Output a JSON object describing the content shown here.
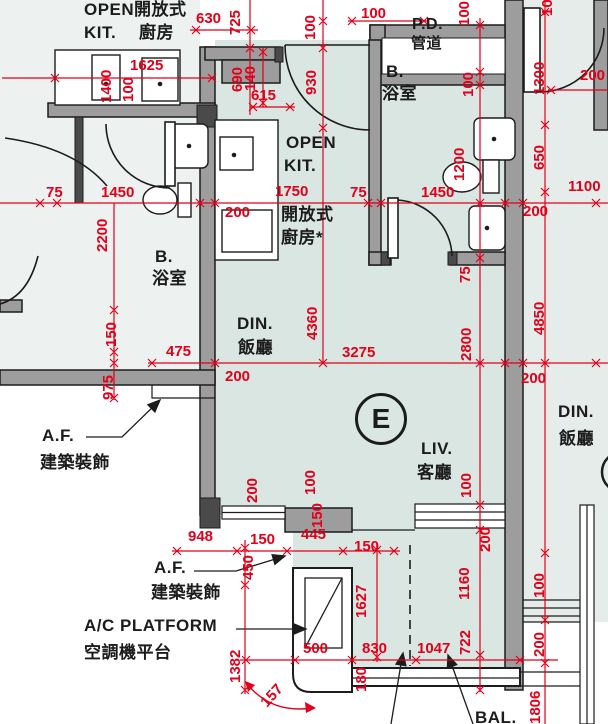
{
  "drawing": {
    "type": "floor-plan",
    "unit": {
      "label": "E"
    }
  },
  "colors": {
    "dimension_red": "#e2001a",
    "wall_fill": "#9d9d9d",
    "wall_dark": "#4a4a4a",
    "line_black": "#1c1c1c",
    "floor_unit_e": "#d9e6e1",
    "floor_left_unit": "#edf1ef",
    "floor_right_unit": "#e6ece9",
    "fixture_white": "#ffffff"
  },
  "annotations": {
    "room_labels": [
      {
        "name": "open-kit-left-line1",
        "text": "OPEN",
        "x": 84,
        "y": 1
      },
      {
        "name": "open-kit-left-line2",
        "text": "KIT.",
        "x": 84,
        "y": 24
      },
      {
        "name": "open-kit-left-zh-line1",
        "text": "開放式",
        "x": 134,
        "y": 1
      },
      {
        "name": "open-kit-left-zh-line2",
        "text": "廚房",
        "x": 139,
        "y": 24
      },
      {
        "name": "pipe-duct-label",
        "text": "P.D.",
        "x": 412,
        "y": 17,
        "size": 16
      },
      {
        "name": "pipe-duct-label-zh",
        "text": "管道",
        "x": 411,
        "y": 36,
        "size": 15
      },
      {
        "name": "bathroom-e-label",
        "text": "B.",
        "x": 386,
        "y": 63
      },
      {
        "name": "bathroom-e-label-zh",
        "text": "浴室",
        "x": 382,
        "y": 85
      },
      {
        "name": "open-kit-e-line1",
        "text": "OPEN",
        "x": 286,
        "y": 134
      },
      {
        "name": "open-kit-e-line2",
        "text": "KIT.",
        "x": 284,
        "y": 157
      },
      {
        "name": "open-kit-e-zh-line1",
        "text": "開放式",
        "x": 281,
        "y": 206
      },
      {
        "name": "open-kit-e-zh-line2",
        "text": "廚房*",
        "x": 281,
        "y": 229
      },
      {
        "name": "bathroom-left-label",
        "text": "B.",
        "x": 155,
        "y": 248
      },
      {
        "name": "bathroom-left-label-zh",
        "text": "浴室",
        "x": 152,
        "y": 270
      },
      {
        "name": "dining-e-label",
        "text": "DIN.",
        "x": 237,
        "y": 315
      },
      {
        "name": "dining-e-label-zh",
        "text": "飯廳",
        "x": 238,
        "y": 339
      },
      {
        "name": "living-e-label",
        "text": "LIV.",
        "x": 421,
        "y": 440
      },
      {
        "name": "living-e-label-zh",
        "text": "客廳",
        "x": 417,
        "y": 464
      },
      {
        "name": "dining-right-label",
        "text": "DIN.",
        "x": 558,
        "y": 403
      },
      {
        "name": "dining-right-label-zh",
        "text": "飯廳",
        "x": 559,
        "y": 430
      },
      {
        "name": "af-upper-label",
        "text": "A.F.",
        "x": 42,
        "y": 427
      },
      {
        "name": "af-upper-label-zh",
        "text": "建築裝飾",
        "x": 40,
        "y": 454
      },
      {
        "name": "af-lower-label",
        "text": "A.F.",
        "x": 154,
        "y": 559
      },
      {
        "name": "af-lower-label-zh",
        "text": "建築裝飾",
        "x": 151,
        "y": 584
      },
      {
        "name": "ac-platform-label",
        "text": "A/C PLATFORM",
        "x": 84,
        "y": 617
      },
      {
        "name": "ac-platform-label-zh",
        "text": "空調機平台",
        "x": 84,
        "y": 644
      },
      {
        "name": "balcony-label",
        "text": "BAL.",
        "x": 475,
        "y": 709
      }
    ],
    "dimension_labels": [
      {
        "text": "630",
        "x": 196,
        "y": 11
      },
      {
        "text": "725",
        "x": 228,
        "y": 35,
        "rot": -90
      },
      {
        "text": "100",
        "x": 303,
        "y": 40,
        "rot": -90
      },
      {
        "text": "930",
        "x": 304,
        "y": 95,
        "rot": -90
      },
      {
        "text": "100",
        "x": 361,
        "y": 6
      },
      {
        "text": "100",
        "x": 457,
        "y": 26,
        "rot": -90
      },
      {
        "text": "100",
        "x": 540,
        "y": 16,
        "rot": -90
      },
      {
        "text": "1400",
        "x": 99,
        "y": 103,
        "rot": -90
      },
      {
        "text": "1625",
        "x": 130,
        "y": 58
      },
      {
        "text": "100",
        "x": 121,
        "y": 102,
        "rot": -90
      },
      {
        "text": "690",
        "x": 230,
        "y": 92,
        "rot": -90
      },
      {
        "text": "140",
        "x": 243,
        "y": 91,
        "rot": -90
      },
      {
        "text": "615",
        "x": 251,
        "y": 88
      },
      {
        "text": "100",
        "x": 461,
        "y": 97,
        "rot": -90
      },
      {
        "text": "1300",
        "x": 532,
        "y": 95,
        "rot": -90
      },
      {
        "text": "200",
        "x": 580,
        "y": 68
      },
      {
        "text": "1200",
        "x": 452,
        "y": 181,
        "rot": -90
      },
      {
        "text": "650",
        "x": 532,
        "y": 170,
        "rot": -90
      },
      {
        "text": "1100",
        "x": 568,
        "y": 179
      },
      {
        "text": "75",
        "x": 46,
        "y": 185
      },
      {
        "text": "1450",
        "x": 101,
        "y": 185
      },
      {
        "text": "1750",
        "x": 275,
        "y": 184
      },
      {
        "text": "75",
        "x": 350,
        "y": 185
      },
      {
        "text": "1450",
        "x": 421,
        "y": 185
      },
      {
        "text": "200",
        "x": 225,
        "y": 205
      },
      {
        "text": "200",
        "x": 523,
        "y": 204
      },
      {
        "text": "2200",
        "x": 95,
        "y": 252,
        "rot": -90
      },
      {
        "text": "75",
        "x": 458,
        "y": 283,
        "rot": -90
      },
      {
        "text": "475",
        "x": 166,
        "y": 344
      },
      {
        "text": "150",
        "x": 104,
        "y": 347,
        "rot": -90
      },
      {
        "text": "975",
        "x": 101,
        "y": 400,
        "rot": -90
      },
      {
        "text": "4360",
        "x": 305,
        "y": 340,
        "rot": -90
      },
      {
        "text": "3275",
        "x": 342,
        "y": 345
      },
      {
        "text": "2800",
        "x": 459,
        "y": 361,
        "rot": -90
      },
      {
        "text": "4850",
        "x": 532,
        "y": 335,
        "rot": -90
      },
      {
        "text": "200",
        "x": 225,
        "y": 369
      },
      {
        "text": "200",
        "x": 521,
        "y": 371
      },
      {
        "text": "100",
        "x": 303,
        "y": 495,
        "rot": -90
      },
      {
        "text": "150",
        "x": 310,
        "y": 528,
        "rot": -90
      },
      {
        "text": "200",
        "x": 245,
        "y": 503,
        "rot": -90
      },
      {
        "text": "100",
        "x": 459,
        "y": 498,
        "rot": -90
      },
      {
        "text": "200",
        "x": 478,
        "y": 552,
        "rot": -90
      },
      {
        "text": "948",
        "x": 188,
        "y": 529
      },
      {
        "text": "450",
        "x": 241,
        "y": 580,
        "rot": -90
      },
      {
        "text": "150",
        "x": 250,
        "y": 532
      },
      {
        "text": "445",
        "x": 301,
        "y": 527
      },
      {
        "text": "150",
        "x": 354,
        "y": 539
      },
      {
        "text": "1627",
        "x": 354,
        "y": 618,
        "rot": -90
      },
      {
        "text": "1160",
        "x": 457,
        "y": 600,
        "rot": -90
      },
      {
        "text": "722",
        "x": 458,
        "y": 655,
        "rot": -90
      },
      {
        "text": "100",
        "x": 532,
        "y": 598,
        "rot": -90
      },
      {
        "text": "200",
        "x": 532,
        "y": 657,
        "rot": -90
      },
      {
        "text": "1806",
        "x": 528,
        "y": 724,
        "rot": -90
      },
      {
        "text": "1382",
        "x": 228,
        "y": 683,
        "rot": -90
      },
      {
        "text": "500",
        "x": 303,
        "y": 641
      },
      {
        "text": "830",
        "x": 362,
        "y": 641
      },
      {
        "text": "1047",
        "x": 417,
        "y": 641
      },
      {
        "text": "180",
        "x": 354,
        "y": 692,
        "rot": -90
      },
      {
        "text": "157",
        "x": 258,
        "y": 700,
        "rot": -48
      }
    ]
  }
}
